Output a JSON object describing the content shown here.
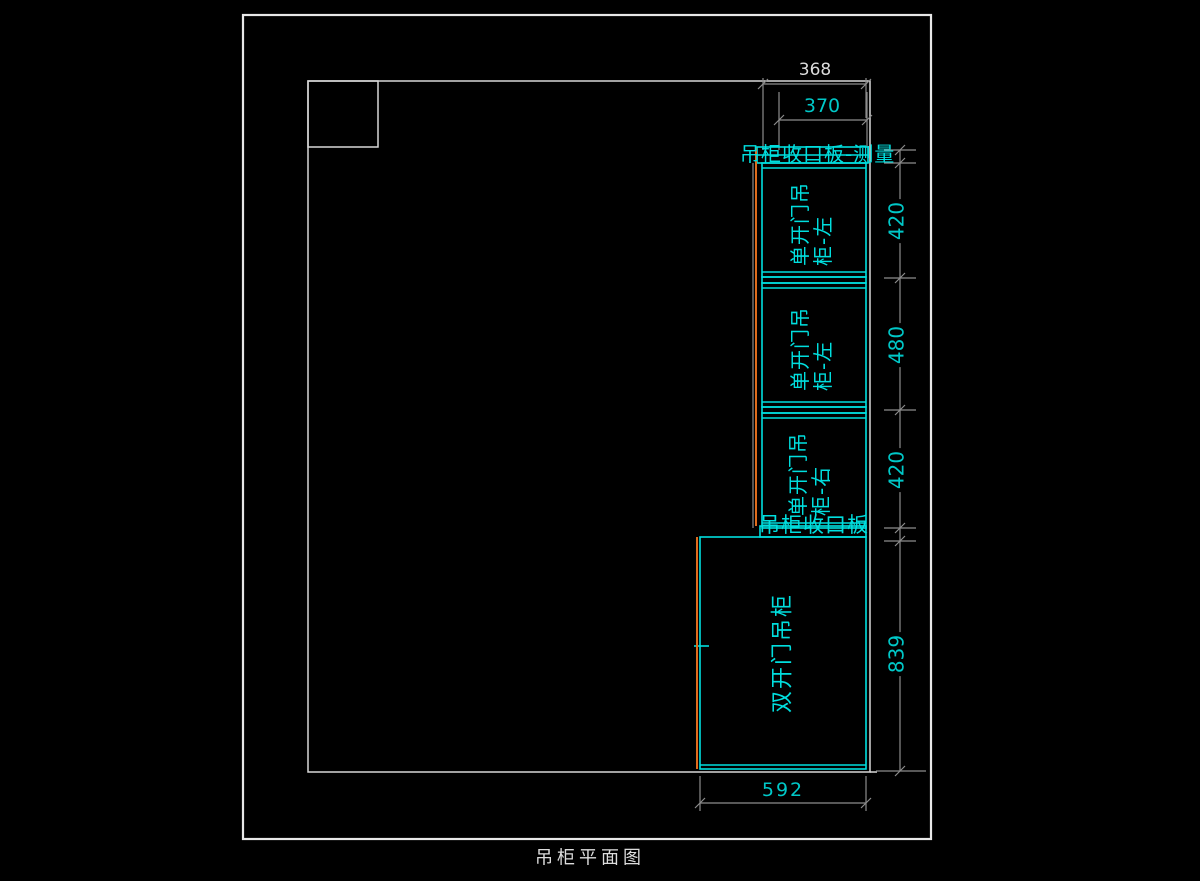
{
  "drawing": {
    "title": "吊柜平面图"
  },
  "colors": {
    "background": "#000000",
    "wall_line": "#e8e8e8",
    "dimension_line": "#8c8c8c",
    "cabinet_line": "#00dede",
    "orange_accent": "#e06c1c",
    "dimension_text_cyan": "#00c8c8",
    "dimension_text_white": "#dcdcdc"
  },
  "labels": {
    "upper_filler": "吊柜收口板-测量",
    "lower_filler": "吊柜收口板",
    "cabinet_top": "单开门吊柜-左",
    "cabinet_middle": "单开门吊柜-左",
    "cabinet_bottom": "单开门吊柜-右",
    "cabinet_large": "双开门吊柜"
  },
  "dimensions": {
    "top_white": "368",
    "top_cyan": "370",
    "right_upper": "420",
    "right_middle": "480",
    "right_lower": "420",
    "right_large": "839",
    "bottom": "592"
  }
}
